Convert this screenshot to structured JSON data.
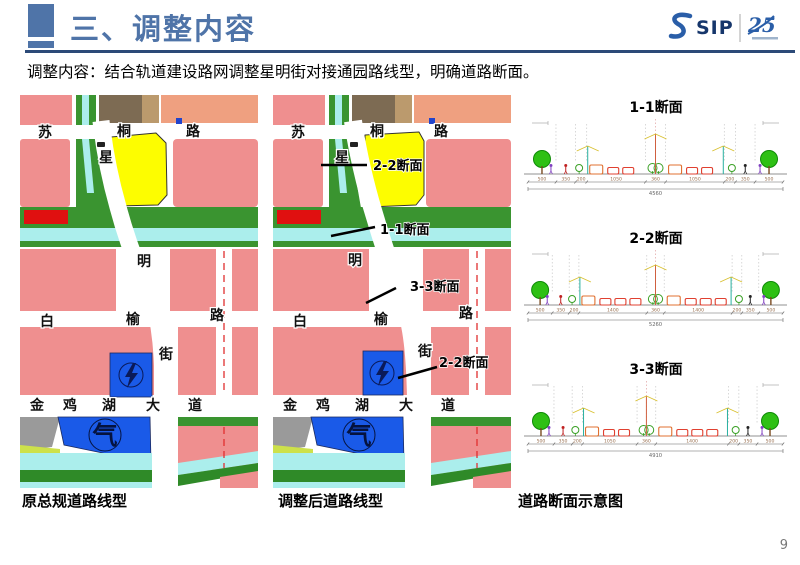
{
  "header": {
    "title": "三、调整内容",
    "logo": {
      "name": "SIP",
      "badge": "25"
    }
  },
  "subtitle": "调整内容：结合轨道建设路网调整星明街对接通园路线型，明确道路断面。",
  "page_number": "9",
  "panels": {
    "left_caption": "原总规道路线型",
    "middle_caption": "调整后道路线型",
    "right_caption": "道路断面示意图"
  },
  "map_labels": {
    "sutong": [
      "苏",
      "桐",
      "路"
    ],
    "xing": "星",
    "ming": "明",
    "jie": "街",
    "baiyu": [
      "白",
      "榆",
      "路"
    ],
    "jinjihu": [
      "金",
      "鸡",
      "湖",
      "大",
      "道"
    ],
    "gas": "气"
  },
  "annotations": {
    "sec22_top": "2-2断面",
    "sec11": "1-1断面",
    "sec33": "3-3断面",
    "sec22_bottom": "2-2断面"
  },
  "sections": [
    {
      "title": "1-1断面",
      "dims": [
        500,
        350,
        200,
        1050,
        360,
        1050,
        200,
        350,
        500
      ],
      "total": 4560
    },
    {
      "title": "2-2断面",
      "dims": [
        500,
        350,
        200,
        1400,
        360,
        1400,
        200,
        350,
        500
      ],
      "total": 5260
    },
    {
      "title": "3-3断面",
      "dims": [
        500,
        350,
        200,
        1050,
        360,
        1400,
        200,
        350,
        500
      ],
      "total": 4910
    }
  ],
  "colors": {
    "accent": "#4f74a8",
    "header_line": "#2c4a78",
    "parcel_pink": "#ef8f8f",
    "parcel_salmon": "#efa080",
    "green_space": "#3a9430",
    "water": "#abeeec",
    "parcel_yellow": "#fdfd00",
    "utility_blue": "#1a5ae8",
    "alert_red": "#e01010"
  }
}
